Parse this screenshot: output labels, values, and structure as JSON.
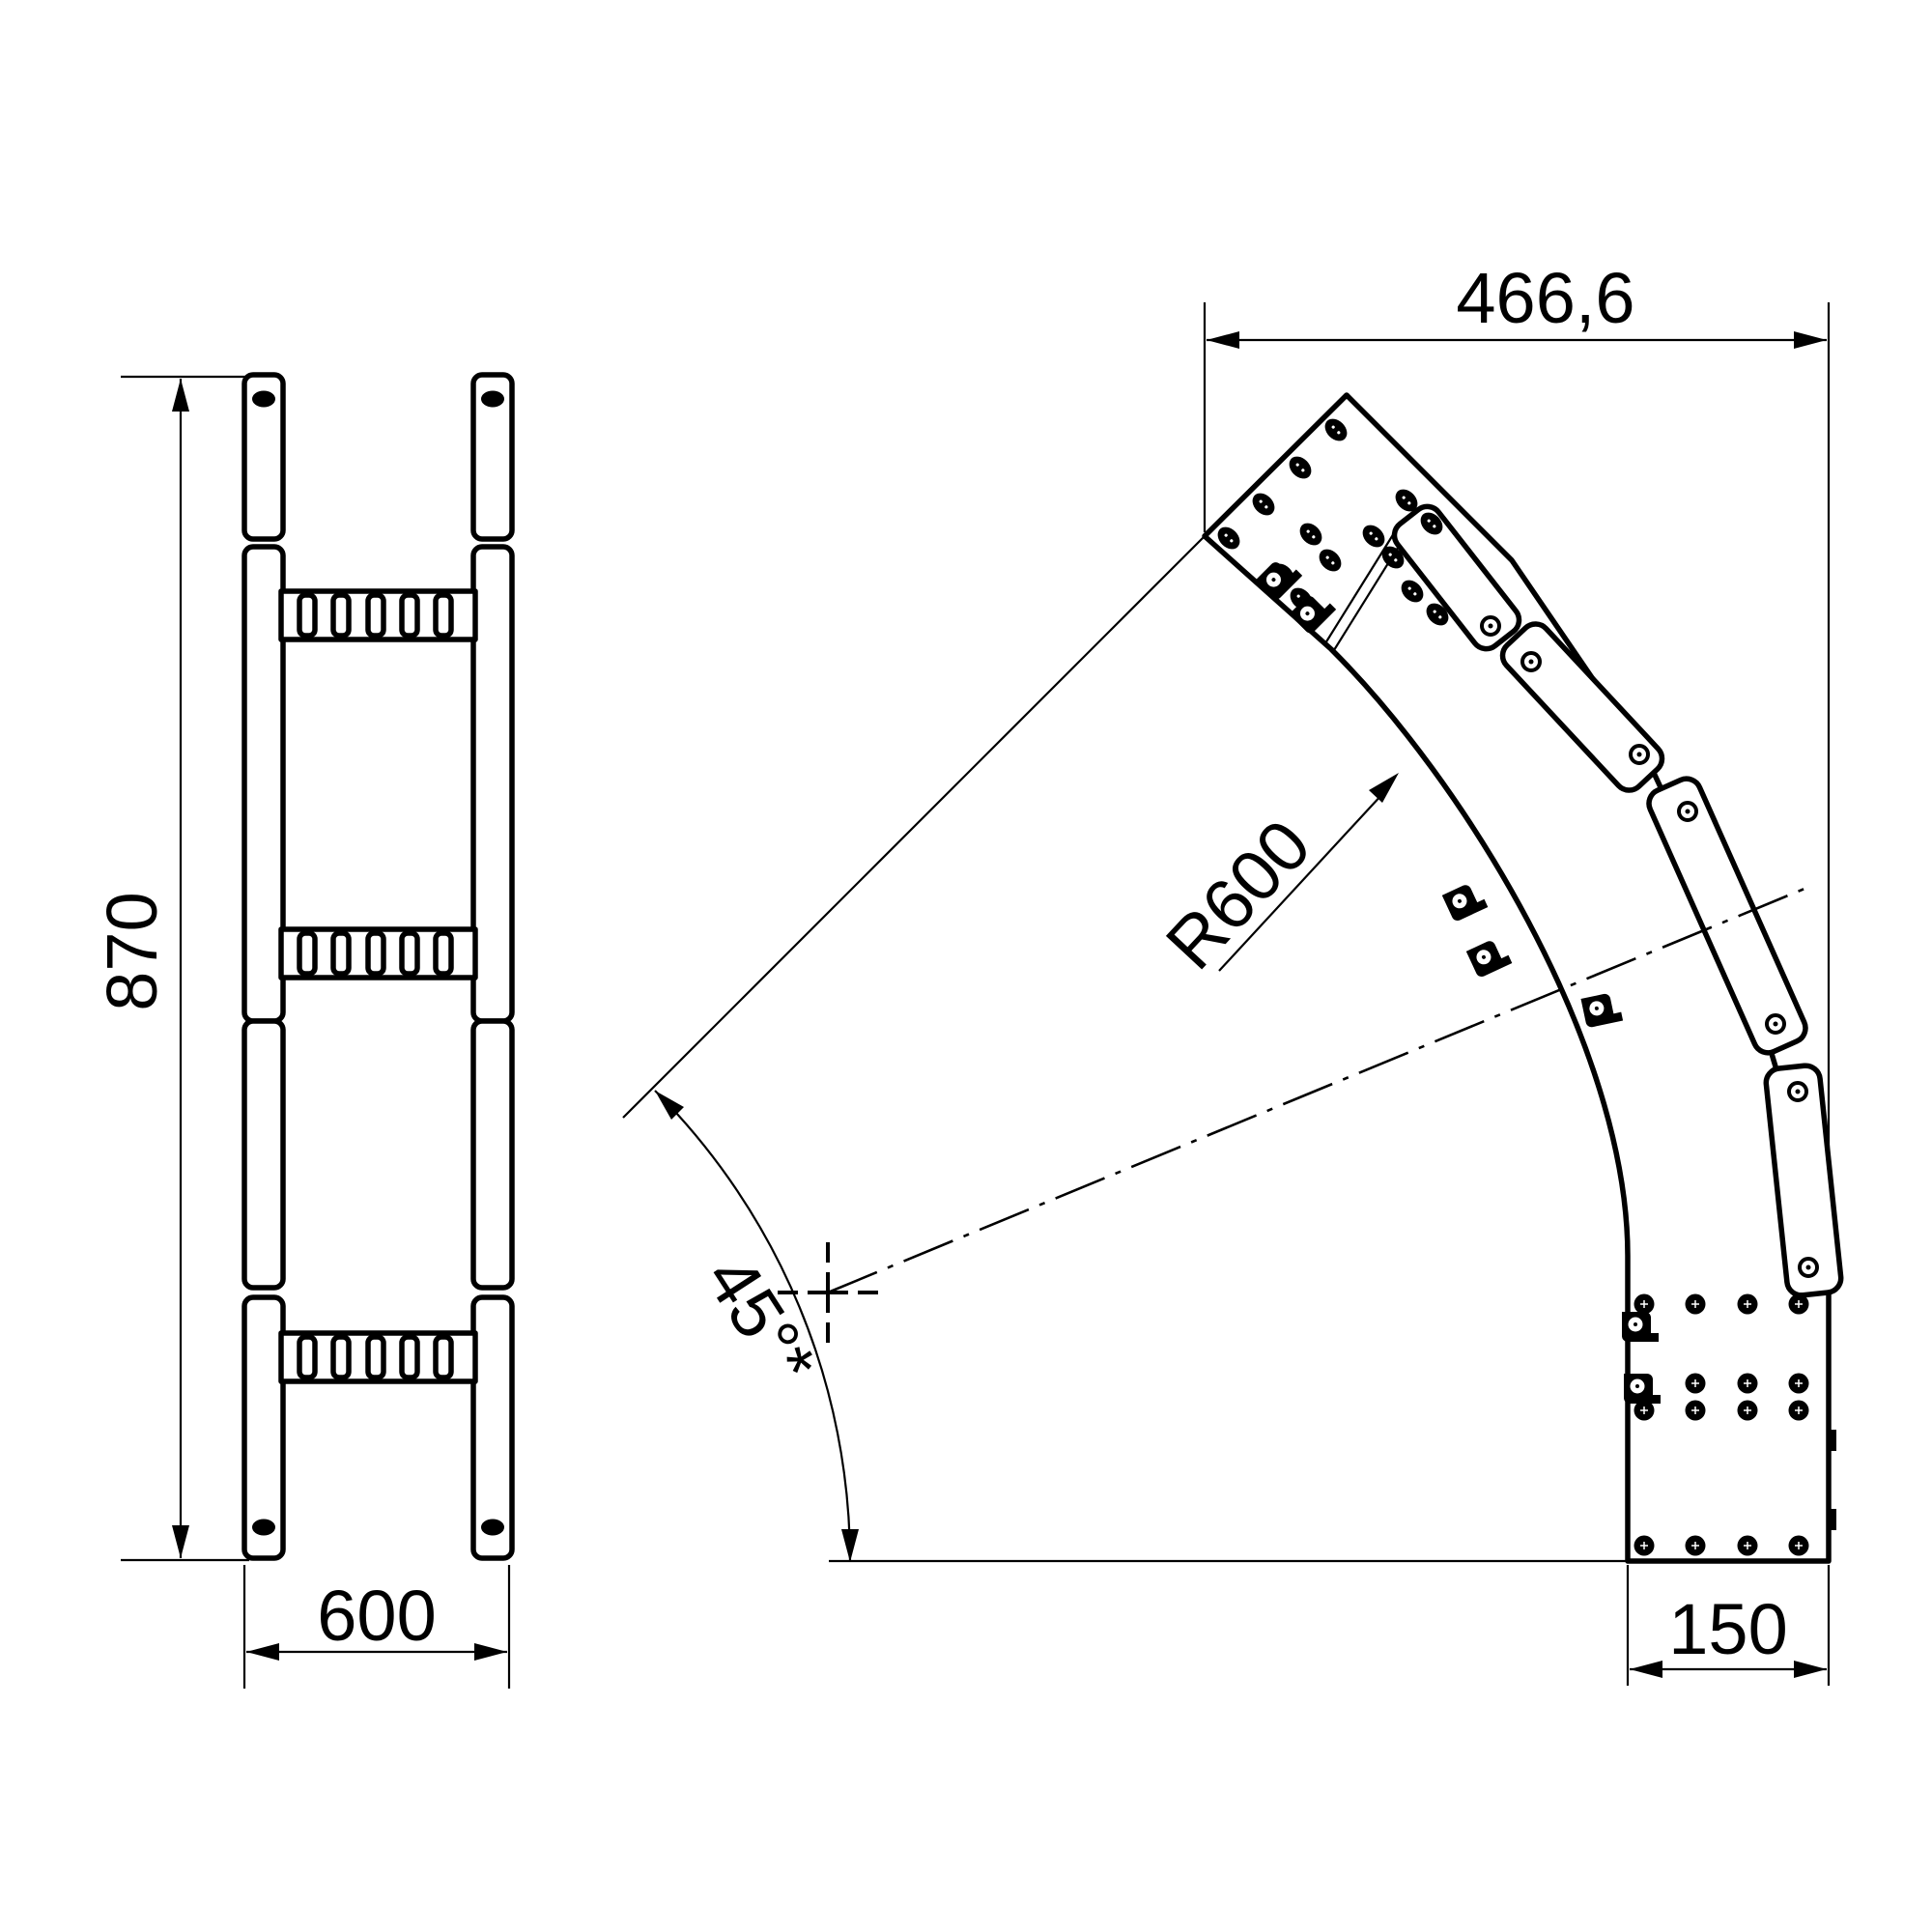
{
  "page": {
    "title": "cable-ladder-45-degree-bend-drawing",
    "background_color": "#ffffff",
    "line_color": "#000000"
  },
  "drawing": {
    "type": "technical-drawing",
    "front_view": {
      "height_dim": "870",
      "width_dim": "600"
    },
    "plan_view": {
      "top_width_dim": "466,6",
      "radius_dim": "R600",
      "angle_dim": "45°*",
      "end_width_dim": "150"
    }
  }
}
